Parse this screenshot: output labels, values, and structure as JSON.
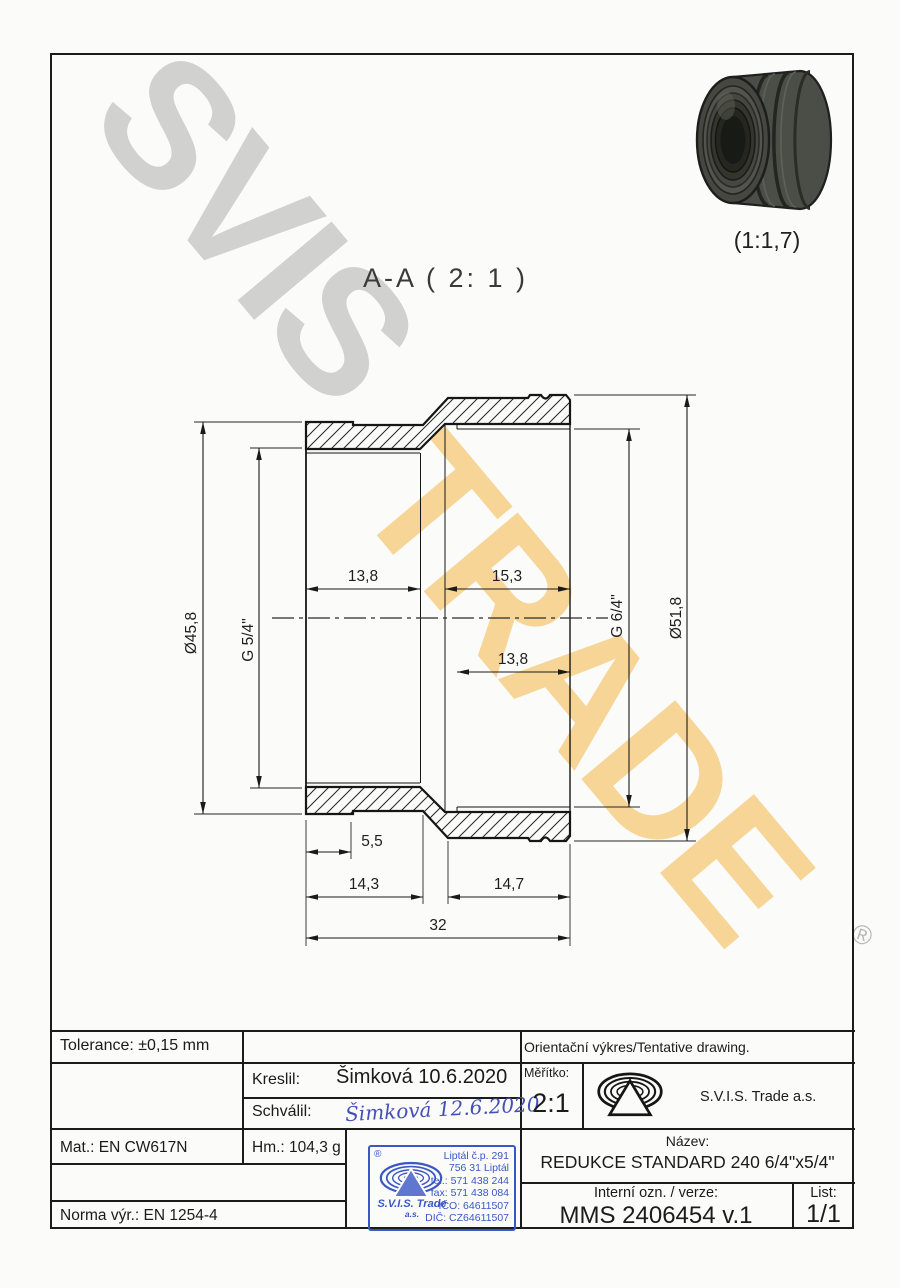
{
  "watermark": {
    "top": "SVIS",
    "bottom": "TRADE",
    "registered": "®"
  },
  "drawing": {
    "section_label": "A-A ( 2: 1 )",
    "photo_scale": "(1:1,7)",
    "dims": {
      "dia_left": "Ø45,8",
      "thread_left": "G 5/4\"",
      "top_left": "13,8",
      "top_right": "15,3",
      "thread_right": "G 6/4\"",
      "dia_right": "Ø51,8",
      "mid_right": "13,8",
      "step": "5,5",
      "bottom_left": "14,3",
      "bottom_right": "14,7",
      "total": "32"
    }
  },
  "titleblock": {
    "tolerance": "Tolerance: ±0,15 mm",
    "orientacni": "Orientační výkres/Tentative drawing.",
    "kreslil_label": "Kreslil:",
    "kreslil_value": "Šimková 10.6.2020",
    "schvalil_label": "Schválil:",
    "schvalil_signature": "Šimková 12.6.2020",
    "meritko_label": "Měřítko:",
    "meritko_value": "2:1",
    "company": "S.V.I.S. Trade a.s.",
    "mat": "Mat.: EN CW617N",
    "hm": "Hm.: 104,3 g",
    "nazev_label": "Název:",
    "nazev_value": "REDUKCE STANDARD 240 6/4\"x5/4\"",
    "interni_label": "Interní ozn. / verze:",
    "interni_value": "MMS 2406454 v.1",
    "list_label": "List:",
    "list_value": "1/1",
    "norma": "Norma výr.: EN 1254-4",
    "stamp": {
      "registered": "®",
      "company": "S.V.I.S. Trade",
      "company_suffix": "a.s.",
      "lines": [
        "Liptál č.p. 291",
        "756 31 Liptál",
        "tel.: 571 438 244",
        "fax: 571 438 084",
        "IČO: 64611507",
        "DIČ: CZ64611507"
      ]
    }
  }
}
